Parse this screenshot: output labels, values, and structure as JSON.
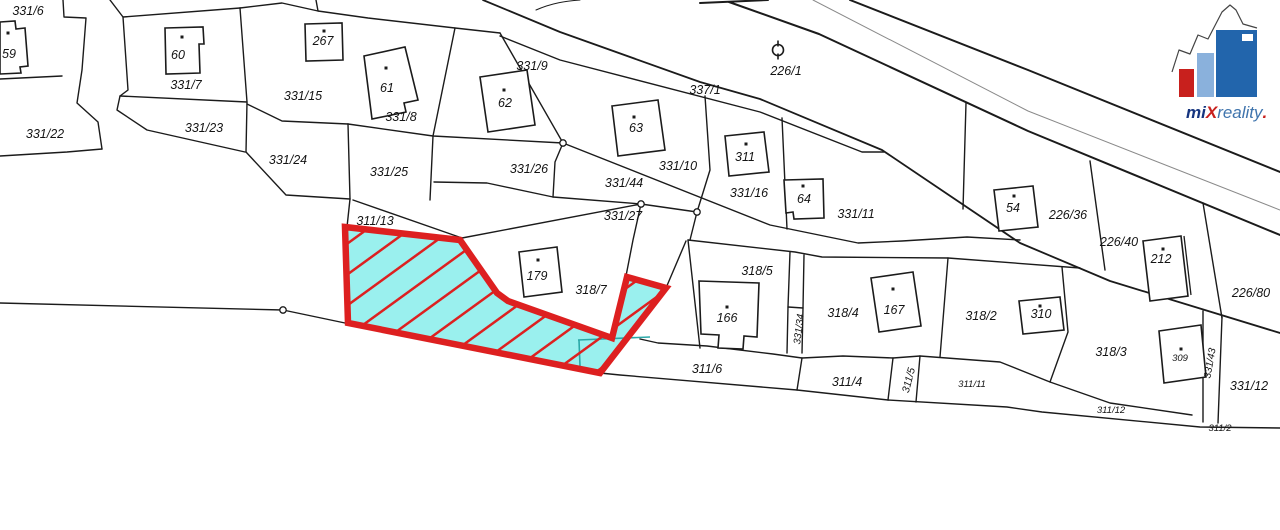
{
  "map": {
    "background": "#ffffff",
    "line_color": "#1b1b1b",
    "gray_line_color": "#8a8a8a",
    "teal_color": "#2aa8a8",
    "highlight": {
      "fill": "#9af0ee",
      "stroke": "#dd2020",
      "outline": [
        [
          345,
          227
        ],
        [
          460,
          240
        ],
        [
          497,
          293
        ],
        [
          508,
          301
        ],
        [
          612,
          338
        ],
        [
          627,
          277
        ],
        [
          666,
          288
        ],
        [
          600,
          373
        ],
        [
          348,
          323
        ]
      ],
      "hatch_angle": -36,
      "hatch_spacing": 25,
      "hatch_width": 5,
      "teal_lines": [
        "M 578 340 L 650 337",
        "M 579 340 L 580 366"
      ]
    },
    "boundaries": [
      {
        "d": "M 0 79 L 62 76"
      },
      {
        "d": "M 63 0 L 64 17 L 86 18 L 82 70 L 77 103 L 98 122 L 102 149"
      },
      {
        "d": "M 0 156 L 67 152 L 102 149"
      },
      {
        "d": "M 110 0 L 123 17 L 128 90 L 120 96 L 117 110 L 147 130 L 245 152"
      },
      {
        "d": "M 123 17 L 240 8"
      },
      {
        "d": "M 120 96 L 247 102"
      },
      {
        "d": "M 240 8 L 247 102 L 246 152"
      },
      {
        "d": "M 246 152 L 286 195 L 350 199"
      },
      {
        "d": "M 247 104 L 282 121 L 348 124"
      },
      {
        "d": "M 348 124 L 350 199"
      },
      {
        "d": "M 348 124 L 433 136 L 563 143"
      },
      {
        "d": "M 455 28 L 433 136 L 430 200"
      },
      {
        "d": "M 434 182 L 487 183 L 553 197"
      },
      {
        "d": "M 350 199 L 347 227"
      },
      {
        "d": "M 353 200 L 462 238"
      },
      {
        "d": "M 553 197 L 641 204 L 697 212"
      },
      {
        "d": "M 641 204 L 462 238"
      },
      {
        "d": "M 563 143 L 770 225 L 858 243 L 902 241 L 967 237 L 1020 240"
      },
      {
        "d": "M 697 212 L 690 240"
      },
      {
        "d": "M 240 8 L 282 3 L 318 11 L 368 18 L 455 28 L 500 33"
      },
      {
        "d": "M 316 0 L 318 11"
      },
      {
        "d": "M 500 33 L 563 143"
      },
      {
        "d": "M 563 143 L 555 162 L 553 197"
      },
      {
        "d": "M 536 10 C 552 3 566 1 580 0",
        "w": 1
      },
      {
        "d": "M 700 3 L 768 0",
        "w": 2
      },
      {
        "d": "M 729 2 L 819 34 L 1028 131 L 1280 235",
        "w": 2
      },
      {
        "d": "M 813 0 L 1028 111 L 1280 210",
        "w": 1,
        "gray": true
      },
      {
        "d": "M 850 0 L 1028 70 L 1280 172",
        "w": 2
      },
      {
        "d": "M 483 0 L 560 32 L 700 82 L 760 99 L 882 150 L 1020 243 L 1110 281 L 1280 333",
        "w": 1.8
      },
      {
        "d": "M 500 36 L 560 60 L 760 112 L 862 152 L 884 152"
      },
      {
        "d": "M 705 96 L 710 170 L 697 212"
      },
      {
        "d": "M 782 118 L 787 229"
      },
      {
        "d": "M 641 204 L 633 240 L 626 276"
      },
      {
        "d": "M 686 241 L 666 288"
      },
      {
        "d": "M 688 240 L 700 348"
      },
      {
        "d": "M 688 240 L 795 252 L 822 257 L 948 258 L 1080 268"
      },
      {
        "d": "M 790 252 L 788 307 L 787 353"
      },
      {
        "d": "M 804 255 L 803 308 L 802 353"
      },
      {
        "d": "M 788 307 L 803 308"
      },
      {
        "d": "M 948 258 L 940 357"
      },
      {
        "d": "M 640 339 L 658 343 L 707 346 L 773 354 L 802 358 L 843 356 L 893 358 L 920 356 L 1000 362 L 1050 382 L 1110 403 L 1192 415"
      },
      {
        "d": "M 600 373 L 620 375 L 797 390 L 888 400 L 1007 407 L 1042 412 L 1200 427 L 1280 428"
      },
      {
        "d": "M 802 358 L 797 390"
      },
      {
        "d": "M 893 358 L 888 400"
      },
      {
        "d": "M 920 356 L 916 402"
      },
      {
        "d": "M 1062 267 L 1068 332 L 1050 382"
      },
      {
        "d": "M 1203 311 L 1203 422"
      },
      {
        "d": "M 1222 317 L 1218 423"
      },
      {
        "d": "M 966 103 L 963 209"
      },
      {
        "d": "M 1090 161 L 1105 270"
      },
      {
        "d": "M 1203 203 L 1222 318"
      },
      {
        "d": "M 0 303 L 283 310 L 345 323"
      }
    ],
    "nodes": [
      [
        563,
        143
      ],
      [
        641,
        204
      ],
      [
        697,
        212
      ],
      [
        283,
        310
      ]
    ],
    "symbol_226_1": {
      "cx": 778,
      "cy": 50,
      "r": 5.5
    },
    "buildings": [
      {
        "n": "59",
        "d": "M 0 22 L 15 21 L 16 29 L 25 28 L 28 66 L 20 67 L 21 73 L 0 74 Z",
        "dot": [
          8,
          33
        ],
        "lx": 9,
        "ly": 58
      },
      {
        "n": "60",
        "d": "M 165 28 L 203 27 L 204 44 L 199 44 L 200 73 L 166 74 Z",
        "dot": [
          182,
          37
        ],
        "lx": 178,
        "ly": 59
      },
      {
        "n": "267",
        "d": "M 305 24 L 342 23 L 343 60 L 306 61 Z",
        "dot": [
          324,
          31
        ],
        "lx": 323,
        "ly": 45
      },
      {
        "n": "61",
        "d": "M 364 56 L 405 47 L 418 100 L 404 103 L 406 112 L 372 119 Z",
        "dot": [
          386,
          68
        ],
        "lx": 387,
        "ly": 92
      },
      {
        "n": "62",
        "d": "M 480 77 L 527 70 L 535 125 L 488 132 Z",
        "dot": [
          504,
          90
        ],
        "lx": 505,
        "ly": 107
      },
      {
        "n": "63",
        "d": "M 612 106 L 658 100 L 665 150 L 618 156 Z",
        "dot": [
          634,
          117
        ],
        "lx": 636,
        "ly": 132
      },
      {
        "n": "311",
        "d": "M 725 136 L 764 132 L 769 172 L 729 176 Z",
        "dot": [
          746,
          144
        ],
        "lx": 745,
        "ly": 161
      },
      {
        "n": "64",
        "d": "M 784 180 L 823 179 L 824 218 L 794 219 L 793 212 L 786 213 Z",
        "dot": [
          803,
          186
        ],
        "lx": 804,
        "ly": 203
      },
      {
        "n": "54",
        "d": "M 994 190 L 1033 186 L 1038 227 L 999 231 Z",
        "dot": [
          1014,
          196
        ],
        "lx": 1013,
        "ly": 212
      },
      {
        "n": "212",
        "d": "M 1143 241 L 1181 236 L 1188 296 L 1150 301 Z",
        "dot": [
          1163,
          249
        ],
        "lx": 1161,
        "ly": 263,
        "extra": "M 1184 236 L 1191 295"
      },
      {
        "n": "310",
        "d": "M 1019 301 L 1060 297 L 1064 330 L 1023 334 Z",
        "dot": [
          1040,
          306
        ],
        "lx": 1041,
        "ly": 318
      },
      {
        "n": "166",
        "d": "M 699 281 L 759 283 L 757 337 L 744 336 L 743 349 L 718 348 L 719 335 L 701 334 Z",
        "dot": [
          727,
          307
        ],
        "lx": 727,
        "ly": 322
      },
      {
        "n": "167",
        "d": "M 871 278 L 913 272 L 921 326 L 879 332 Z",
        "dot": [
          893,
          289
        ],
        "lx": 894,
        "ly": 314
      },
      {
        "n": "309",
        "d": "M 1159 331 L 1201 325 L 1206 377 L 1164 383 Z",
        "dot": [
          1181,
          349
        ],
        "lx": 1180,
        "ly": 361,
        "fs": 9.5
      },
      {
        "n": "179",
        "d": "M 519 252 L 557 247 L 562 292 L 524 297 Z",
        "dot": [
          538,
          260
        ],
        "lx": 537,
        "ly": 280
      }
    ],
    "parcel_labels": [
      {
        "t": "331/6",
        "x": 28,
        "y": 11
      },
      {
        "t": "331/7",
        "x": 186,
        "y": 85
      },
      {
        "t": "331/22",
        "x": 45,
        "y": 134
      },
      {
        "t": "331/23",
        "x": 204,
        "y": 128
      },
      {
        "t": "331/15",
        "x": 303,
        "y": 96
      },
      {
        "t": "331/24",
        "x": 288,
        "y": 160
      },
      {
        "t": "331/25",
        "x": 389,
        "y": 172
      },
      {
        "t": "331/26",
        "x": 529,
        "y": 169
      },
      {
        "t": "331/8",
        "x": 401,
        "y": 117
      },
      {
        "t": "331/9",
        "x": 532,
        "y": 66
      },
      {
        "t": "337/1",
        "x": 705,
        "y": 90
      },
      {
        "t": "226/1",
        "x": 786,
        "y": 71
      },
      {
        "t": "331/10",
        "x": 678,
        "y": 166
      },
      {
        "t": "331/44",
        "x": 624,
        "y": 183
      },
      {
        "t": "331/27",
        "x": 623,
        "y": 216
      },
      {
        "t": "331/16",
        "x": 749,
        "y": 193
      },
      {
        "t": "331/11",
        "x": 856,
        "y": 214
      },
      {
        "t": "311/13",
        "x": 375,
        "y": 221
      },
      {
        "t": "318/7",
        "x": 591,
        "y": 290
      },
      {
        "t": "318/5",
        "x": 757,
        "y": 271
      },
      {
        "t": "318/4",
        "x": 843,
        "y": 313
      },
      {
        "t": "318/2",
        "x": 981,
        "y": 316
      },
      {
        "t": "226/36",
        "x": 1068,
        "y": 215
      },
      {
        "t": "226/40",
        "x": 1119,
        "y": 242
      },
      {
        "t": "226/80",
        "x": 1251,
        "y": 293
      },
      {
        "t": "318/3",
        "x": 1111,
        "y": 352
      },
      {
        "t": "331/12",
        "x": 1249,
        "y": 386
      },
      {
        "t": "311/6",
        "x": 707,
        "y": 369
      },
      {
        "t": "311/4",
        "x": 847,
        "y": 382
      },
      {
        "t": "311/11",
        "x": 972,
        "y": 383,
        "fs": 9.5
      },
      {
        "t": "311/12",
        "x": 1111,
        "y": 409,
        "fs": 9.5
      },
      {
        "t": "311/2",
        "x": 1220,
        "y": 427,
        "fs": 9.5
      },
      {
        "t": "331/34",
        "x": 798,
        "y": 329,
        "fs": 10,
        "rot": -83
      },
      {
        "t": "311/5",
        "x": 908,
        "y": 380,
        "fs": 10.5,
        "rot": -75
      },
      {
        "t": "331/43",
        "x": 1209,
        "y": 363,
        "fs": 10,
        "rot": -80
      }
    ]
  },
  "logo": {
    "text_mi": "mi",
    "text_x": "X",
    "text_rest": "reality",
    "text_dot": ".",
    "color_navy": "#16357f",
    "color_red": "#c8201d",
    "color_steel": "#3f74ad",
    "color_light_blue": "#8ab1dc",
    "color_mid_blue": "#2265ac",
    "buildings": {
      "red": [
        1179,
        69,
        15,
        28
      ],
      "light": [
        1197,
        53,
        17,
        44
      ],
      "dark": [
        1216,
        30,
        41,
        67
      ],
      "window": [
        1242,
        34,
        11,
        7
      ]
    },
    "skyline": "M 1172 72 L 1179 50 L 1190 54 L 1198 35 L 1208 39 L 1222 12 L 1230 5 L 1236 10 L 1243 24 L 1257 28",
    "text_pos": [
      1186,
      118
    ]
  }
}
